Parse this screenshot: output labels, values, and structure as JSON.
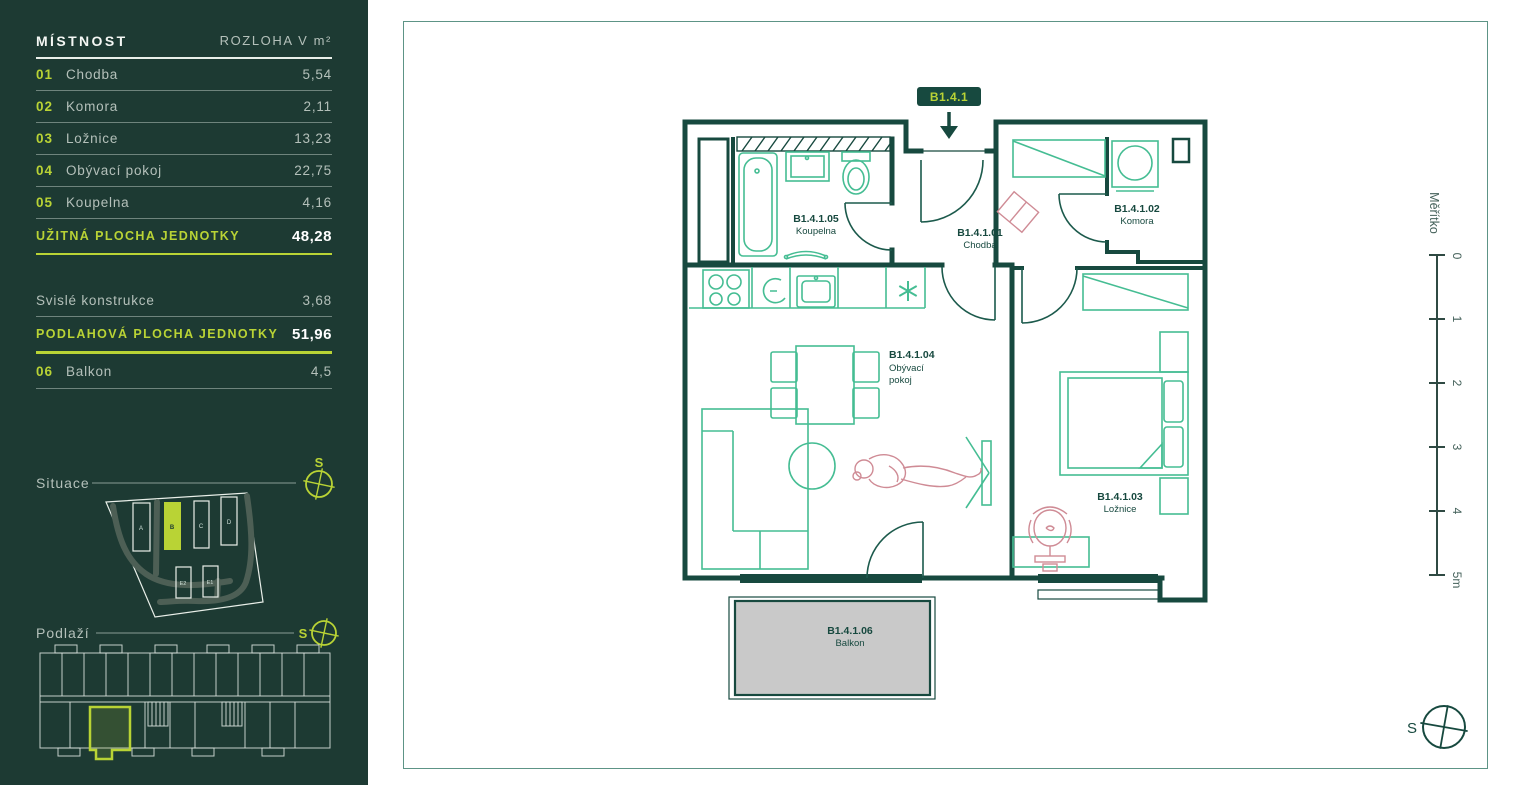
{
  "sidebar": {
    "table": {
      "col_room": "MÍSTNOST",
      "col_area": "ROZLOHA V m²",
      "rows": [
        {
          "num": "01",
          "name": "Chodba",
          "area": "5,54"
        },
        {
          "num": "02",
          "name": "Komora",
          "area": "2,11"
        },
        {
          "num": "03",
          "name": "Ložnice",
          "area": "13,23"
        },
        {
          "num": "04",
          "name": "Obývací pokoj",
          "area": "22,75"
        },
        {
          "num": "05",
          "name": "Koupelna",
          "area": "4,16"
        }
      ],
      "usable_label": "UŽITNÁ PLOCHA JEDNOTKY",
      "usable_value": "48,28",
      "construction_label": "Svislé konstrukce",
      "construction_value": "3,68",
      "floor_label": "PODLAHOVÁ PLOCHA JEDNOTKY",
      "floor_value": "51,96",
      "balcony_num": "06",
      "balcony_name": "Balkon",
      "balcony_area": "4,5"
    },
    "situace_label": "Situace",
    "podlazi_label": "Podlaží",
    "site_compass_letter": "S",
    "floor_compass_letter": "S",
    "buildings": [
      {
        "label": "A"
      },
      {
        "label": "B"
      },
      {
        "label": "C"
      },
      {
        "label": "D"
      },
      {
        "label": "E2"
      },
      {
        "label": "E1"
      }
    ]
  },
  "plan": {
    "unit_badge": "B1.4.1",
    "rooms": [
      {
        "id": "B1.4.1.05",
        "name": "Koupelna"
      },
      {
        "id": "B1.4.1.01",
        "name": "Chodba"
      },
      {
        "id": "B1.4.1.02",
        "name": "Komora"
      },
      {
        "id": "B1.4.1.04",
        "name": "Obývací pokoj",
        "lines": [
          "Obývací",
          "pokoj"
        ]
      },
      {
        "id": "B1.4.1.03",
        "name": "Ložnice"
      },
      {
        "id": "B1.4.1.06",
        "name": "Balkon"
      }
    ],
    "scale_label": "Měřítko",
    "scale_ticks": [
      "0",
      "1",
      "2",
      "3",
      "4",
      "5m"
    ],
    "compass_letter": "S"
  },
  "colors": {
    "accent": "#b9d335",
    "sidebar_bg": "#1d3a33",
    "wall": "#17493f",
    "furniture": "#45bd93",
    "figure_pink": "#cf8b95",
    "muted_text": "#b4c0ba",
    "balcony_fill": "#c9c9c9"
  }
}
